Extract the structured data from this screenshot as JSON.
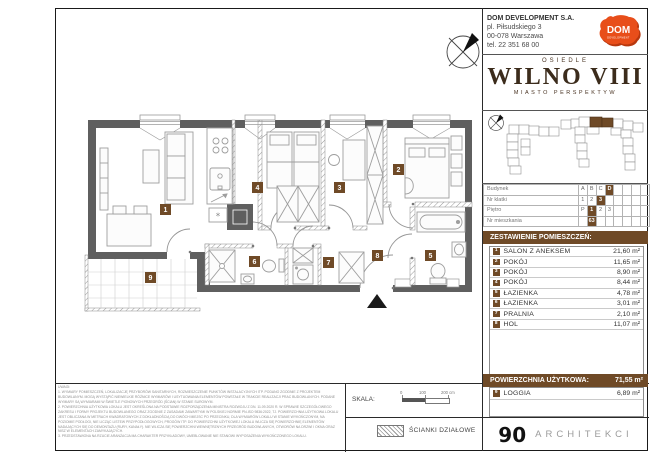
{
  "header": {
    "company": [
      "DOM DEVELOPMENT S.A.",
      "pl. Piłsudskiego 3",
      "00-078 Warszawa",
      "tel. 22 351 68 00"
    ],
    "logo_text": "DOM",
    "logo_subtext": "DEVELOPMENT",
    "estate_label": "OSIEDLE",
    "estate_name": "WILNO VIII",
    "estate_subtitle": "MIASTO PERSPEKTYW"
  },
  "unit_table": {
    "rows": [
      {
        "label": "Budynek",
        "cells": [
          "A",
          "B",
          "C",
          "D",
          "",
          "",
          "",
          ""
        ]
      },
      {
        "label": "Nr klatki",
        "cells": [
          "1",
          "2",
          "3",
          "",
          "",
          "",
          "",
          ""
        ]
      },
      {
        "label": "Piętro",
        "cells": [
          "P",
          "1",
          "2",
          "3",
          "",
          "",
          "",
          ""
        ]
      },
      {
        "label": "Nr mieszkania",
        "cells": [
          "",
          "63",
          "",
          "",
          "",
          "",
          "",
          ""
        ]
      }
    ]
  },
  "rooms": {
    "title": "ZESTAWIENIE POMIESZCZEŃ:",
    "items": [
      {
        "no": "1",
        "name": "SALON Z ANEKSEM",
        "area": "21,60 m²"
      },
      {
        "no": "2",
        "name": "POKÓJ",
        "area": "11,65 m²"
      },
      {
        "no": "3",
        "name": "POKÓJ",
        "area": "8,90 m²"
      },
      {
        "no": "4",
        "name": "POKÓJ",
        "area": "8,44 m²"
      },
      {
        "no": "5",
        "name": "ŁAZIENKA",
        "area": "4,78 m²"
      },
      {
        "no": "6",
        "name": "ŁAZIENKA",
        "area": "3,01 m²"
      },
      {
        "no": "7",
        "name": "PRALNIA",
        "area": "2,10 m²"
      },
      {
        "no": "8",
        "name": "HOL",
        "area": "11,07 m²"
      }
    ]
  },
  "summary": {
    "label": "POWIERZCHNIA UŻYTKOWA:",
    "value": "71,55 m²"
  },
  "loggia": {
    "no": "9",
    "name": "LOGGIA",
    "area": "6,89 m²"
  },
  "footer": {
    "scale_label": "SKALA:",
    "scale_ticks": [
      "0",
      "100",
      "200 cm"
    ],
    "walls_legend": "ŚCIANKI DZIAŁOWE",
    "studio_number": "90",
    "studio_name": "ARCHITEKCI"
  },
  "notes": {
    "lines": [
      "UWAGI:",
      "1.  WYMIARY POMIESZCZEŃ, LOKALIZACJĘ PRZYBORÓW SANITARNYCH, ROZMIESZCZENIE PUNKTÓW INSTALACYJNYCH ITP. PODANO ZGODNIE Z PROJEKTEM BUDOWLANYM. MOGĄ WYSTĄPIĆ NIEWIELKIE RÓŻNICE WYMIARÓW I USYTUOWANIA ELEMENTÓW POWSTAŁE W TRAKCIE REALIZACJI PRAC BUDOWLANYCH. PODANE WYMIARY SĄ WYMIARAMI W ŚWIETLE PIONOWYCH PRZEGRÓD (ŚCIAN) W STANIE SUROWYM.",
      "2.  POWIERZCHNIA UŻYTKOWA LOKALU JEST OKREŚLONA NA PODSTAWIE ROZPORZĄDZENIA MINISTRA ROZWOJU Z DN. 11.09.2020 R. W SPRAWIE SZCZEGÓŁOWEGO ZAKRESU I FORMY PROJEKTU BUDOWLANEGO ORAZ ZGODNIE Z ZASADAMI ZAWARTYMI W POLSKIEJ NORMIE PN-ISO 9836:2022, TJ. POWIERZCHNIA UŻYTKOWA LOKALU JEST OBLICZANA W METRACH KWADRATOWYCH Z DOKŁADNOŚCIĄ DO DWÓCH MIEJSC PO PRZECINKU, DLA WYMIARÓW LOKALU W STANIE WYKOŃCZONYM, NA POZIOMIE PODŁOGI, NIE LICZĄC LISTEW PRZYPODŁOGOWYCH, PROGÓW ITP. DO POWIERZCHNI UŻYTKOWEJ LOKALU WLICZA SIĘ POWIERZCHNIĘ ELEMENTÓW NADAJĄCYCH SIĘ DO DEMONTAŻU (RURY, KANAŁY). NIE WLICZA SIĘ POWIERZCHNI WEWNĘTRZNYCH PRZEGRÓD BUDOWLANYCH, OTWORÓW NA DRZWI I OKNA ORAZ NISZ W ELEMENTACH ZAMYKAJĄCYCH.",
      "3.  PRZEDSTAWIONA NA RZUCIE ARANŻACJA MA CHARAKTER PRZYKŁADOWY, UMEBLOWANIE NIE STANOWI WYPOSAŻENIA WYKOŃCZONEGO LOKALU."
    ]
  },
  "plan": {
    "labels": [
      "1",
      "2",
      "3",
      "4",
      "5",
      "6",
      "7",
      "8",
      "9"
    ]
  },
  "colors": {
    "accent_brown": "#6f4a27",
    "logo_orange": "#e84e1a",
    "wall_gray": "#5f5f5f"
  }
}
